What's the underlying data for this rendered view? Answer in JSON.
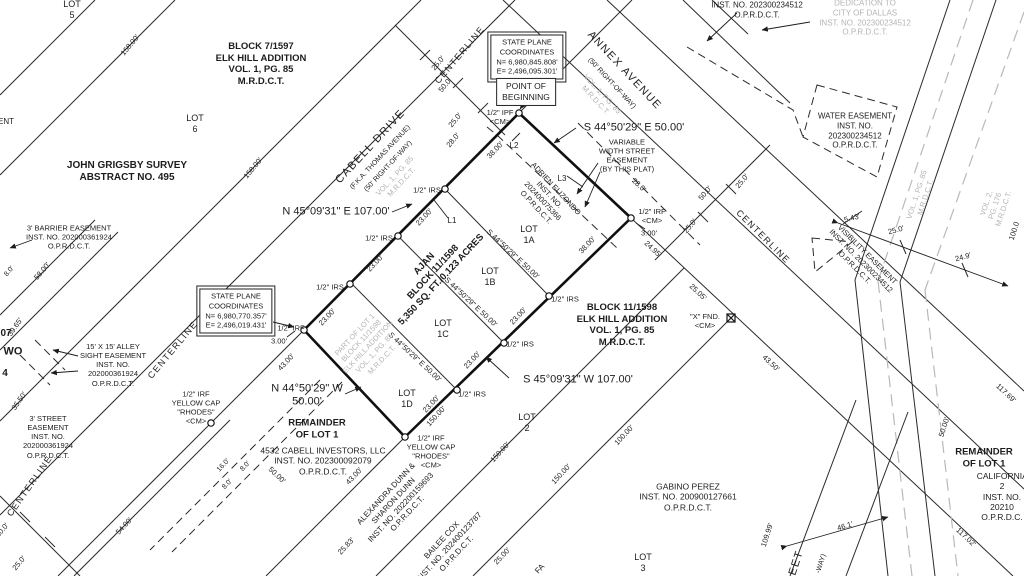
{
  "colors": {
    "ink": "#1c1c1c",
    "ghost_gray": "#b4b4b4",
    "paper": "#ffffff"
  },
  "labels": {
    "lot5": "LOT\n5",
    "lot6": "LOT\n6",
    "lot1a": "LOT\n1A",
    "lot1b": "LOT\n1B",
    "lot1c": "LOT\n1C",
    "lot1d": "LOT\n1D",
    "lot2": "LOT\n2",
    "lot3": "LOT\n3",
    "block7": "BLOCK 7/1597\nELK HILL ADDITION\nVOL. 1, PG. 85\nM.R.D.C.T.",
    "block11": "BLOCK 11/1598\nELK HILL ADDITION\nVOL. 1, PG. 85\nM.R.D.C.T.",
    "grigsby": "JOHN GRIGSBY SURVEY\nABSTRACT NO. 495",
    "ajan": "AJAN\nBLOCK 11/1598\n5,350 SQ. FT./0.123 ACRES",
    "part_lot1": "PART OF LOT 1\nBLOCK 11/1598\nELK HILL ADDITION\nVOL. 1, PG. 85\nM.R.D.C.T.",
    "remainder": "REMAINDER\nOF LOT 1",
    "centerline": "CENTERLINE",
    "ent_frag": "ENT",
    "frag07": "07",
    "fragWO": "WO",
    "frag4": "4",
    "fragFA": "FA",
    "frag_eet": "EET",
    "frag_way": "-WAY)",
    "frag100": "100.0"
  },
  "streets": {
    "annex_name": "ANNEX AVENUE",
    "annex_row": "(50' RIGHT-OF-WAY)",
    "cabell_name": "CABELL DRIVE",
    "cabell_fka": "(F.K.A. THOMAS AVENUE)",
    "cabell_row": "(50' RIGHT-OF-WAY)",
    "vol1": "VOL. 1, PG. 85\nM.R.D.C.T.",
    "vol2": "VOL. 2, PG. 176\nM.R.D.C.T."
  },
  "owners": {
    "adrien": "ADRIEN ELIZONDO\nINST. NO.\n202400075366\nO.P.R.D.C.T.",
    "cabell_inv": "4532 CABELL INVESTORS, LLC\nINST. NO. 202300092079\nO.P.R.D.C.T.",
    "dunn": "ALEXANDRA DUNN &\nSHARON DUNN\nINST. NO. 202200159693\nO.P.R.D.C.T.",
    "cox": "BAILEE COX\nINST. NO. 202400123787\nO.P.R.D.C.T.",
    "perez": "GABINO PEREZ\nINST. NO. 200900127661\nO.P.R.D.C.T.",
    "california": "CALIFORNIA 2\nINST. NO. 20210\nO.P.R.D.C."
  },
  "easements": {
    "barrier": "3' BARRIER EASEMENT\nINST. NO. 202000361924\nO.P.R.D.C.T.",
    "alley": "15' X 15' ALLEY\nSIGHT EASEMENT\nINST. NO.\n202000361924\nO.P.R.D.C.T.",
    "street3": "3' STREET\nEASEMENT\nINST. NO.\n202000361924\nO.P.R.D.C.T.",
    "water": "WATER EASEMENT\nINST. NO.\n202300234512\nO.P.R.D.C.T.",
    "visibility": "VISIBILITY EASEMENT\nINST. NO. 202300234512\nO.P.R.D.C.T.",
    "var_width": "VARIABLE\nWIDTH STREET\nEASEMENT\n(BY THIS PLAT)",
    "dedication": "DEDICATION TO\nCITY OF DALLAS\nINST. NO. 202300234512\nO.P.R.D.C.T.",
    "inst_top": "INST. NO. 202300234512\nO.P.R.D.C.T."
  },
  "bearings": {
    "ne": "S 44°50'29\" E    50.00'",
    "nw": "N 45°09'31\" E    107.00'",
    "se": "S 45°09'31\" W    107.00'",
    "sw": "N 44°50'29\" W\n50.00'",
    "inner": "S 44°50'29\" E   50.00'"
  },
  "monuments": {
    "ipf": "1/2\" IPF\n<CM>",
    "irf_cm": "1/2\" IRF\n<CM>",
    "irf": "1/2\" IRF",
    "irs": "1/2\" IRS",
    "rhodes": "1/2\" IRF\nYELLOW CAP\n\"RHODES\"\n<CM>",
    "xfnd": "\"X\" FND.\n<CM>",
    "l1": "L1",
    "l2": "L2",
    "l3": "L3"
  },
  "boxes": {
    "sp1": "STATE PLANE\nCOORDINATES\nN= 6,980,845.808'\nE= 2,496,095.301'",
    "sp2": "STATE PLANE\nCOORDINATES\nN= 6,980,770.357'\nE= 2,496,019.431'",
    "pob": "POINT OF\nBEGINNING"
  },
  "dims": {
    "d158": "158.00'",
    "d23": "23.00'",
    "d38": "38.00'",
    "d43": "43.00'",
    "d54": "54.00'",
    "d58": "58.00'",
    "d150": "150.00'",
    "d100": "100.00'",
    "d50": "50.00'",
    "d50_0": "50.0'",
    "d25_0": "25.0'",
    "d28": "28.0'",
    "d16": "16.0'",
    "d8": "8.0'",
    "d3": "3.00'",
    "d2495": "24.95'",
    "d2505": "25.05'",
    "d4350": "43.50'",
    "d543": "5.43'",
    "d249": "24.9'",
    "d2583": "25.83'",
    "d2500": "25.00'",
    "d10999": "109.99'",
    "d11702": "117.02'",
    "d11769": "117.69'",
    "d461": "46.1'",
    "d3965": "39.65'",
    "d3550": "35.50'"
  }
}
